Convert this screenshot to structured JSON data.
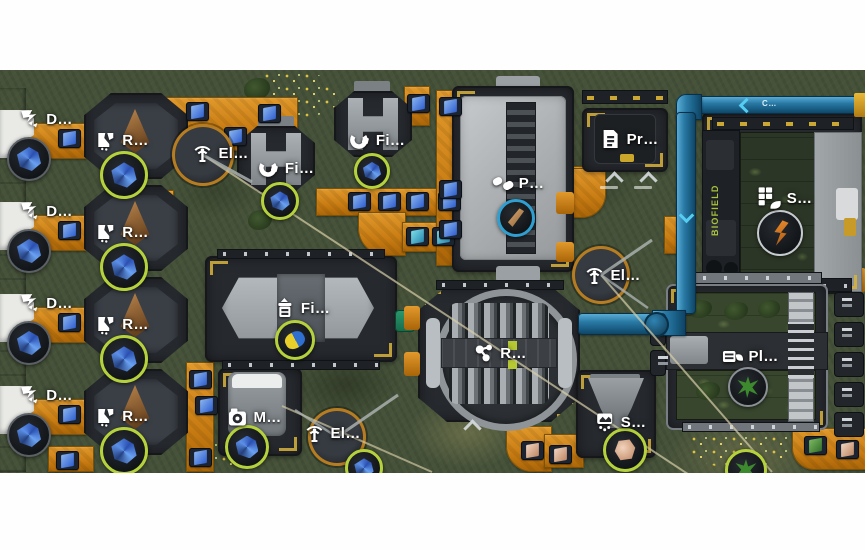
{
  "palette": {
    "grass": "#46523a",
    "belt_orange": "#cd7f16",
    "accent_yellow": "#d9b43c",
    "pipe_blue": "#2a7aa6",
    "ring_green": "#b5d23c",
    "ring_cyan": "#2e9fd0",
    "platform_dark": "#26292e",
    "machine_gray": "#a8aeb2",
    "biofield_text_green": "#a9c23c",
    "label_white": "#ffffff"
  },
  "labels": {
    "drill": "D…",
    "refiner": "R…",
    "power_pole": "El…",
    "smelter": "Fi…",
    "factory": "Fi…",
    "press": "P…",
    "printer": "Pr…",
    "reactor": "R…",
    "bio_generator": "S…",
    "sifter": "S…",
    "miner": "M…",
    "planter": "Pl…"
  },
  "texts": {
    "biofield_sign": "BIOFIELD",
    "pipe_tag": "C…"
  },
  "items": {
    "blue_crystal": "#4f7fe0",
    "teal_crystal": "#56c8d8",
    "metal_rod": "#c29a66",
    "capsule": "#e8cf2a",
    "rock": "#d9c9a8",
    "ember_plant": "#e07818",
    "green_plant": "#3d8a2e",
    "brown_cone": "#a06a38"
  }
}
